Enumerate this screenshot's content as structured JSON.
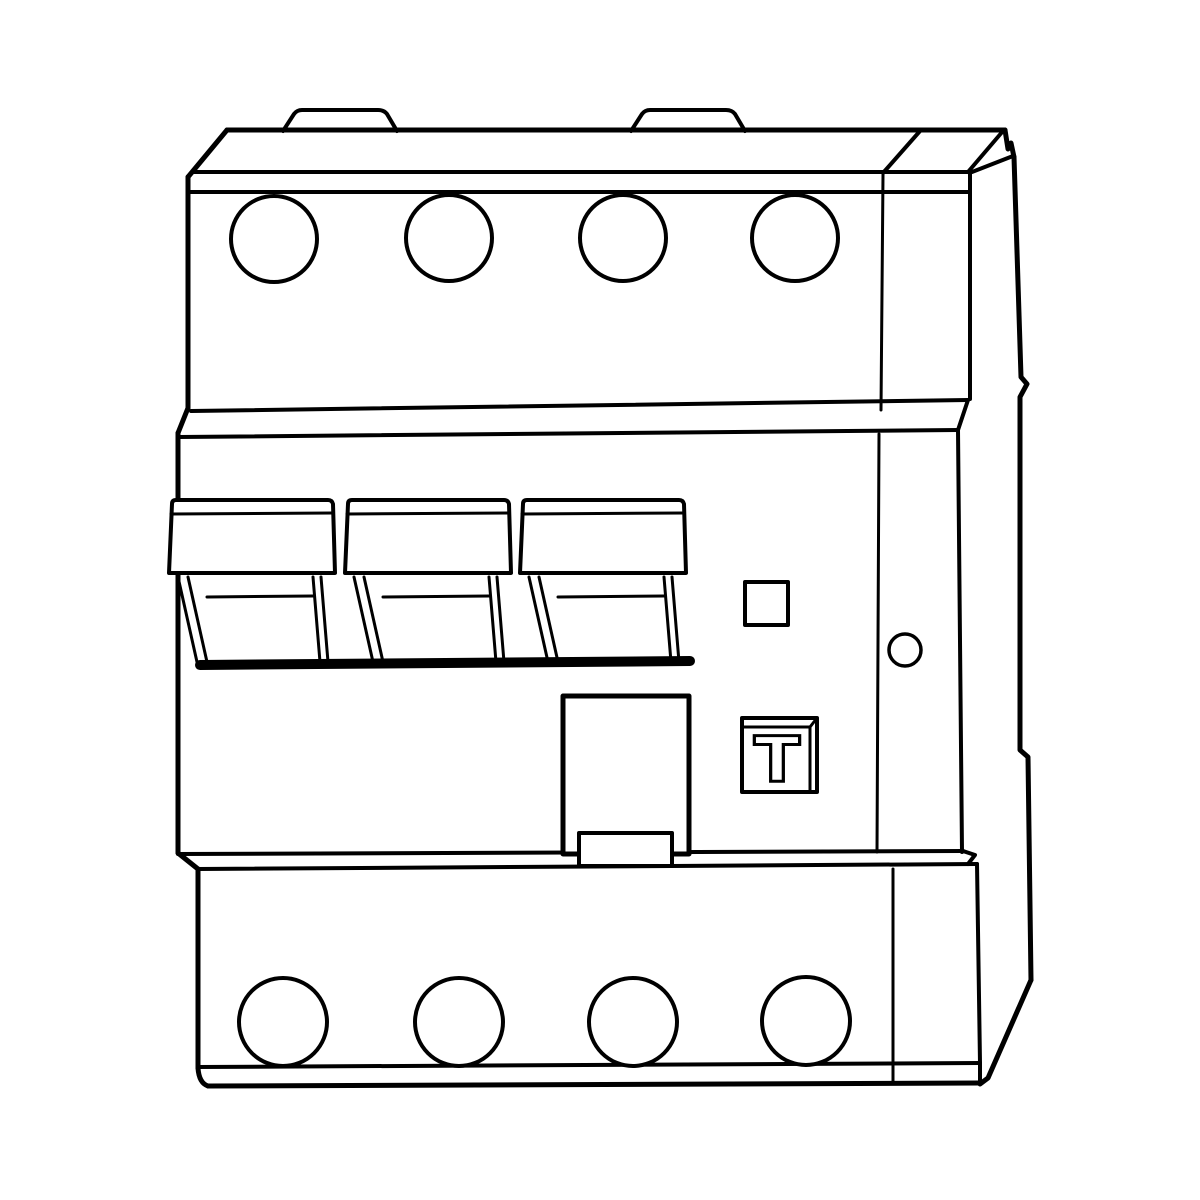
{
  "illustration": {
    "subject": "four-pole residual current circuit breaker, front three-quarter technical line drawing",
    "mounting_tabs": 2,
    "top_terminal_screws": 4,
    "bottom_terminal_screws": 4,
    "toggle_switches": 3,
    "indicator_windows": 2,
    "test_button": {
      "label": "T"
    }
  },
  "colors": {
    "line": "#000000",
    "background": "#ffffff"
  }
}
